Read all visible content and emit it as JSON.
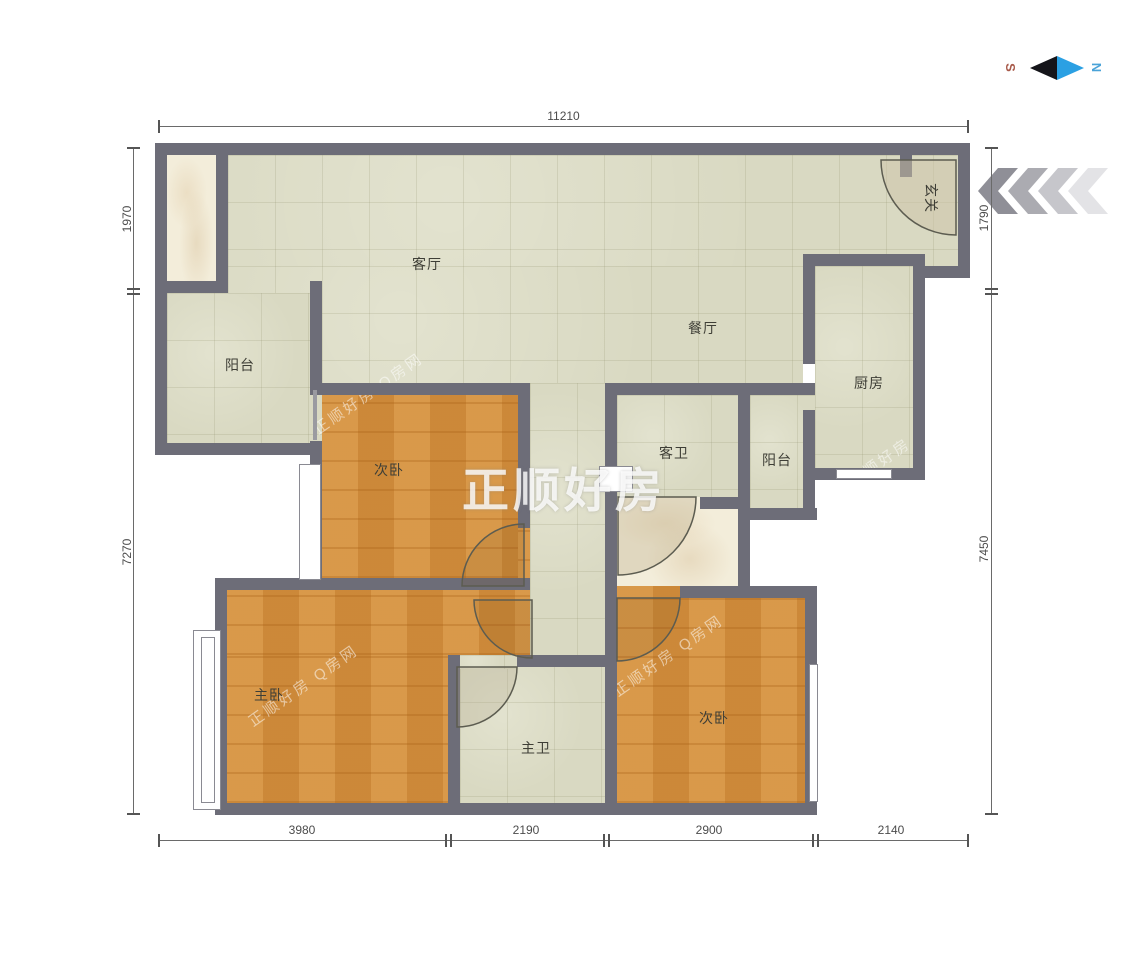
{
  "compass": {
    "south": "S",
    "north": "N"
  },
  "dimensions": {
    "top": "11210",
    "left_upper": "1970",
    "left_lower": "7270",
    "right_upper": "1790",
    "right_lower": "7450",
    "bottom": [
      "3980",
      "2190",
      "2900",
      "2140"
    ]
  },
  "rooms": {
    "living_room": "客厅",
    "dining_room": "餐厅",
    "balcony_left": "阳台",
    "balcony_middle": "阳台",
    "bedroom_top": "次卧",
    "bedroom_bottom_right": "次卧",
    "master_bedroom": "主卧",
    "kitchen": "厨房",
    "guest_bathroom": "客卫",
    "master_bathroom": "主卫",
    "entryway": "玄关"
  },
  "watermarks": {
    "center": "正顺好房",
    "diagonal": "正顺好房  Q房网"
  },
  "colors": {
    "wall": "#6d6d78",
    "tile_floor": "#d9d9c2",
    "wood_floor": "#d28f3e",
    "marble_floor": "#f3edda",
    "compass_north": "#35a3e0",
    "compass_south": "#a85a4a",
    "entry_arrow_dark": "#8f8f97",
    "entry_arrow_light": "#e3e3e6"
  }
}
